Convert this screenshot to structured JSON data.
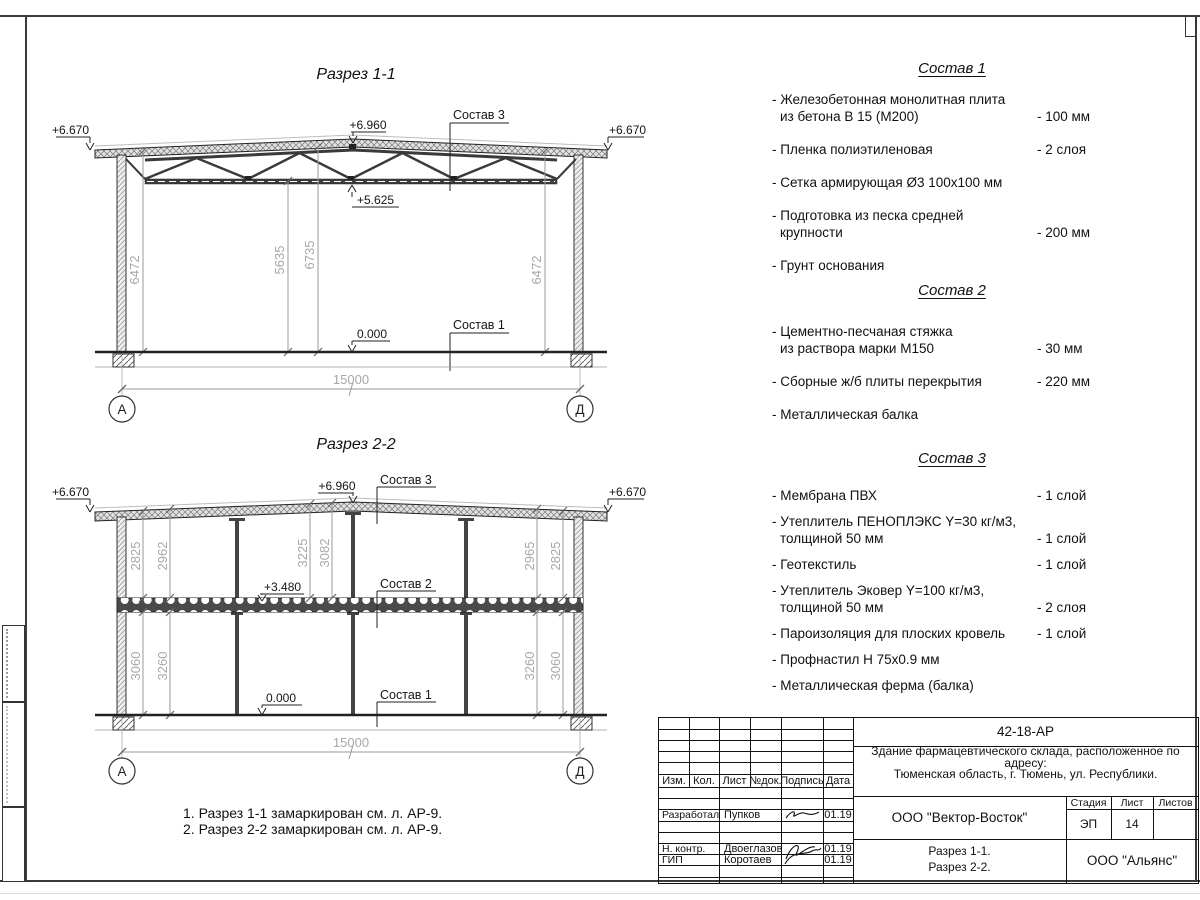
{
  "section1": {
    "title": "Разрез 1-1",
    "elev_eaves_left": "+6.670",
    "elev_eaves_right": "+6.670",
    "elev_peak": "+6.960",
    "elev_truss": "+5.625",
    "elev_floor": "0.000",
    "callout_roof": "Состав 3",
    "callout_floor": "Состав 1",
    "dim_left": "6472",
    "dim_inner_left": "5635",
    "dim_inner_right": "6735",
    "dim_right": "6472",
    "dim_span": "15000",
    "axis_left": "А",
    "axis_right": "Д"
  },
  "section2": {
    "title": "Разрез 2-2",
    "elev_eaves_left": "+6.670",
    "elev_eaves_right": "+6.670",
    "elev_peak": "+6.960",
    "elev_mid": "+3.480",
    "elev_floor": "0.000",
    "callout_roof": "Состав 3",
    "callout_mid": "Состав 2",
    "callout_floor": "Состав 1",
    "dims_upper": [
      "2825",
      "2962",
      "3225",
      "3082",
      "2965",
      "2825"
    ],
    "dims_lower": [
      "3060",
      "3260",
      "3260",
      "3060"
    ],
    "dim_span": "15000",
    "axis_left": "А",
    "axis_right": "Д"
  },
  "compositions": [
    {
      "title": "Состав 1",
      "items": [
        {
          "line1": "- Железобетонная  монолитная плита",
          "line2": "из бетона В 15 (М200)",
          "value": "- 100 мм"
        },
        {
          "line1": "- Пленка полиэтиленовая",
          "value": "-  2 слоя"
        },
        {
          "line1": "- Сетка армирующая Ø3 100х100 мм",
          "value": ""
        },
        {
          "line1": "- Подготовка из песка средней",
          "line2": "крупности",
          "value": "- 200 мм"
        },
        {
          "line1": "- Грунт основания",
          "value": ""
        }
      ]
    },
    {
      "title": "Состав 2",
      "items": [
        {
          "line1": "- Цементно-песчаная стяжка",
          "line2": "из раствора марки М150",
          "value": "- 30 мм"
        },
        {
          "line1": "- Сборные ж/б плиты перекрытия",
          "value": "- 220 мм"
        },
        {
          "line1": "- Металлическая балка",
          "value": ""
        }
      ]
    },
    {
      "title": "Состав 3",
      "items": [
        {
          "line1": "- Мембрана ПВХ",
          "value": "- 1 слой"
        },
        {
          "line1": "- Утеплитель ПЕНОПЛЭКС Y=30 кг/м3,",
          "line2": "толщиной 50 мм",
          "value": "- 1 слой"
        },
        {
          "line1": "- Геотекстиль",
          "value": "- 1 слой"
        },
        {
          "line1": "- Утеплитель Эковер Y=100 кг/м3,",
          "line2": "толщиной 50 мм",
          "value": "- 2 слоя"
        },
        {
          "line1": "- Пароизоляция для плоских кровель",
          "value": "- 1 слой"
        },
        {
          "line1": "- Профнастил Н 75х0.9 мм",
          "value": ""
        },
        {
          "line1": "- Металлическая ферма (балка)",
          "value": ""
        }
      ]
    }
  ],
  "notes": [
    "1. Разрез 1-1 замаркирован см. л. АР-9.",
    "2. Разрез 2-2 замаркирован см. л. АР-9."
  ],
  "titleblock": {
    "doc_code": "42-18-АР",
    "project_line1": "Здание фармацевтического склада, расположенное по адресу:",
    "project_line2": "Тюменская область, г. Тюмень, ул. Республики.",
    "col_headers": {
      "izm": "Изм.",
      "kol": "Кол.",
      "list": "Лист",
      "ndok": "№док.",
      "podpis": "Подпись",
      "data": "Дата"
    },
    "rows": [
      {
        "role": "Разработал",
        "name": "Пупков",
        "date": "01.19"
      },
      {
        "role": "Н. контр.",
        "name": "Двоеглазов",
        "date": "01.19"
      },
      {
        "role": "ГИП",
        "name": "Коротаев",
        "date": "01.19"
      }
    ],
    "designer": "ООО \"Вектор-Восток\"",
    "stage_label": "Стадия",
    "sheet_label": "Лист",
    "sheets_label": "Листов",
    "stage": "ЭП",
    "sheet": "14",
    "sheets": "",
    "drawing_line1": "Разрез 1-1.",
    "drawing_line2": "Разрез 2-2.",
    "contractor": "ООО \"Альянс\""
  }
}
